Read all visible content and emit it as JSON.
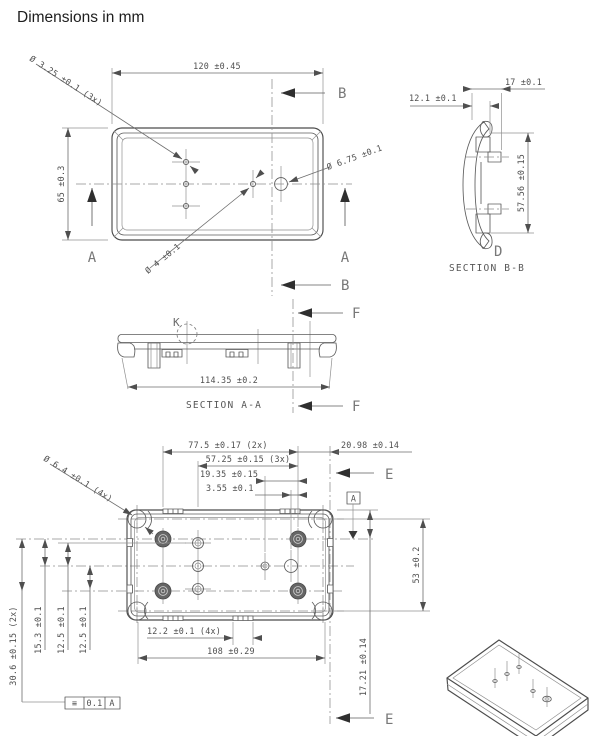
{
  "title": "Dimensions in mm",
  "top": {
    "dim_w": "120 ±0.45",
    "dim_h": "65 ±0.3",
    "lead_small": "Ø 3.25 ±0.1 (3x)",
    "lead_mid": "Ø 4 ±0.1",
    "lead_big": "Ø 6.75 ±0.1",
    "a": "A",
    "b": "B"
  },
  "aa": {
    "title": "SECTION A-A",
    "dim": "114.35 ±0.2",
    "k": "K",
    "f": "F"
  },
  "bb": {
    "title": "SECTION B-B",
    "dim_w": "17 ±0.1",
    "dim_step": "12.1 ±0.1",
    "dim_h": "57.56 ±0.15",
    "d": "D"
  },
  "bot": {
    "t1": "77.5 ±0.17 (2x)",
    "t2": "57.25 ±0.15 (3x)",
    "t3": "19.35 ±0.15",
    "t4": "3.55 ±0.1",
    "t5": "20.98 ±0.14",
    "L1": "30.6 ±0.15 (2x)",
    "L2": "15.3 ±0.1",
    "L3": "12.5 ±0.1",
    "L4": "12.5 ±0.1",
    "b1": "12.2 ±0.1 (4x)",
    "b2": "108 ±0.29",
    "r1": "53 ±0.2",
    "r2": "17.21 ±0.14",
    "lead_corner": "Ø 6.4 ±0.1 (4x)",
    "datum": "A",
    "e": "E",
    "fcf_sym": "≡",
    "fcf_tol": "0.1",
    "fcf_dat": "A"
  }
}
